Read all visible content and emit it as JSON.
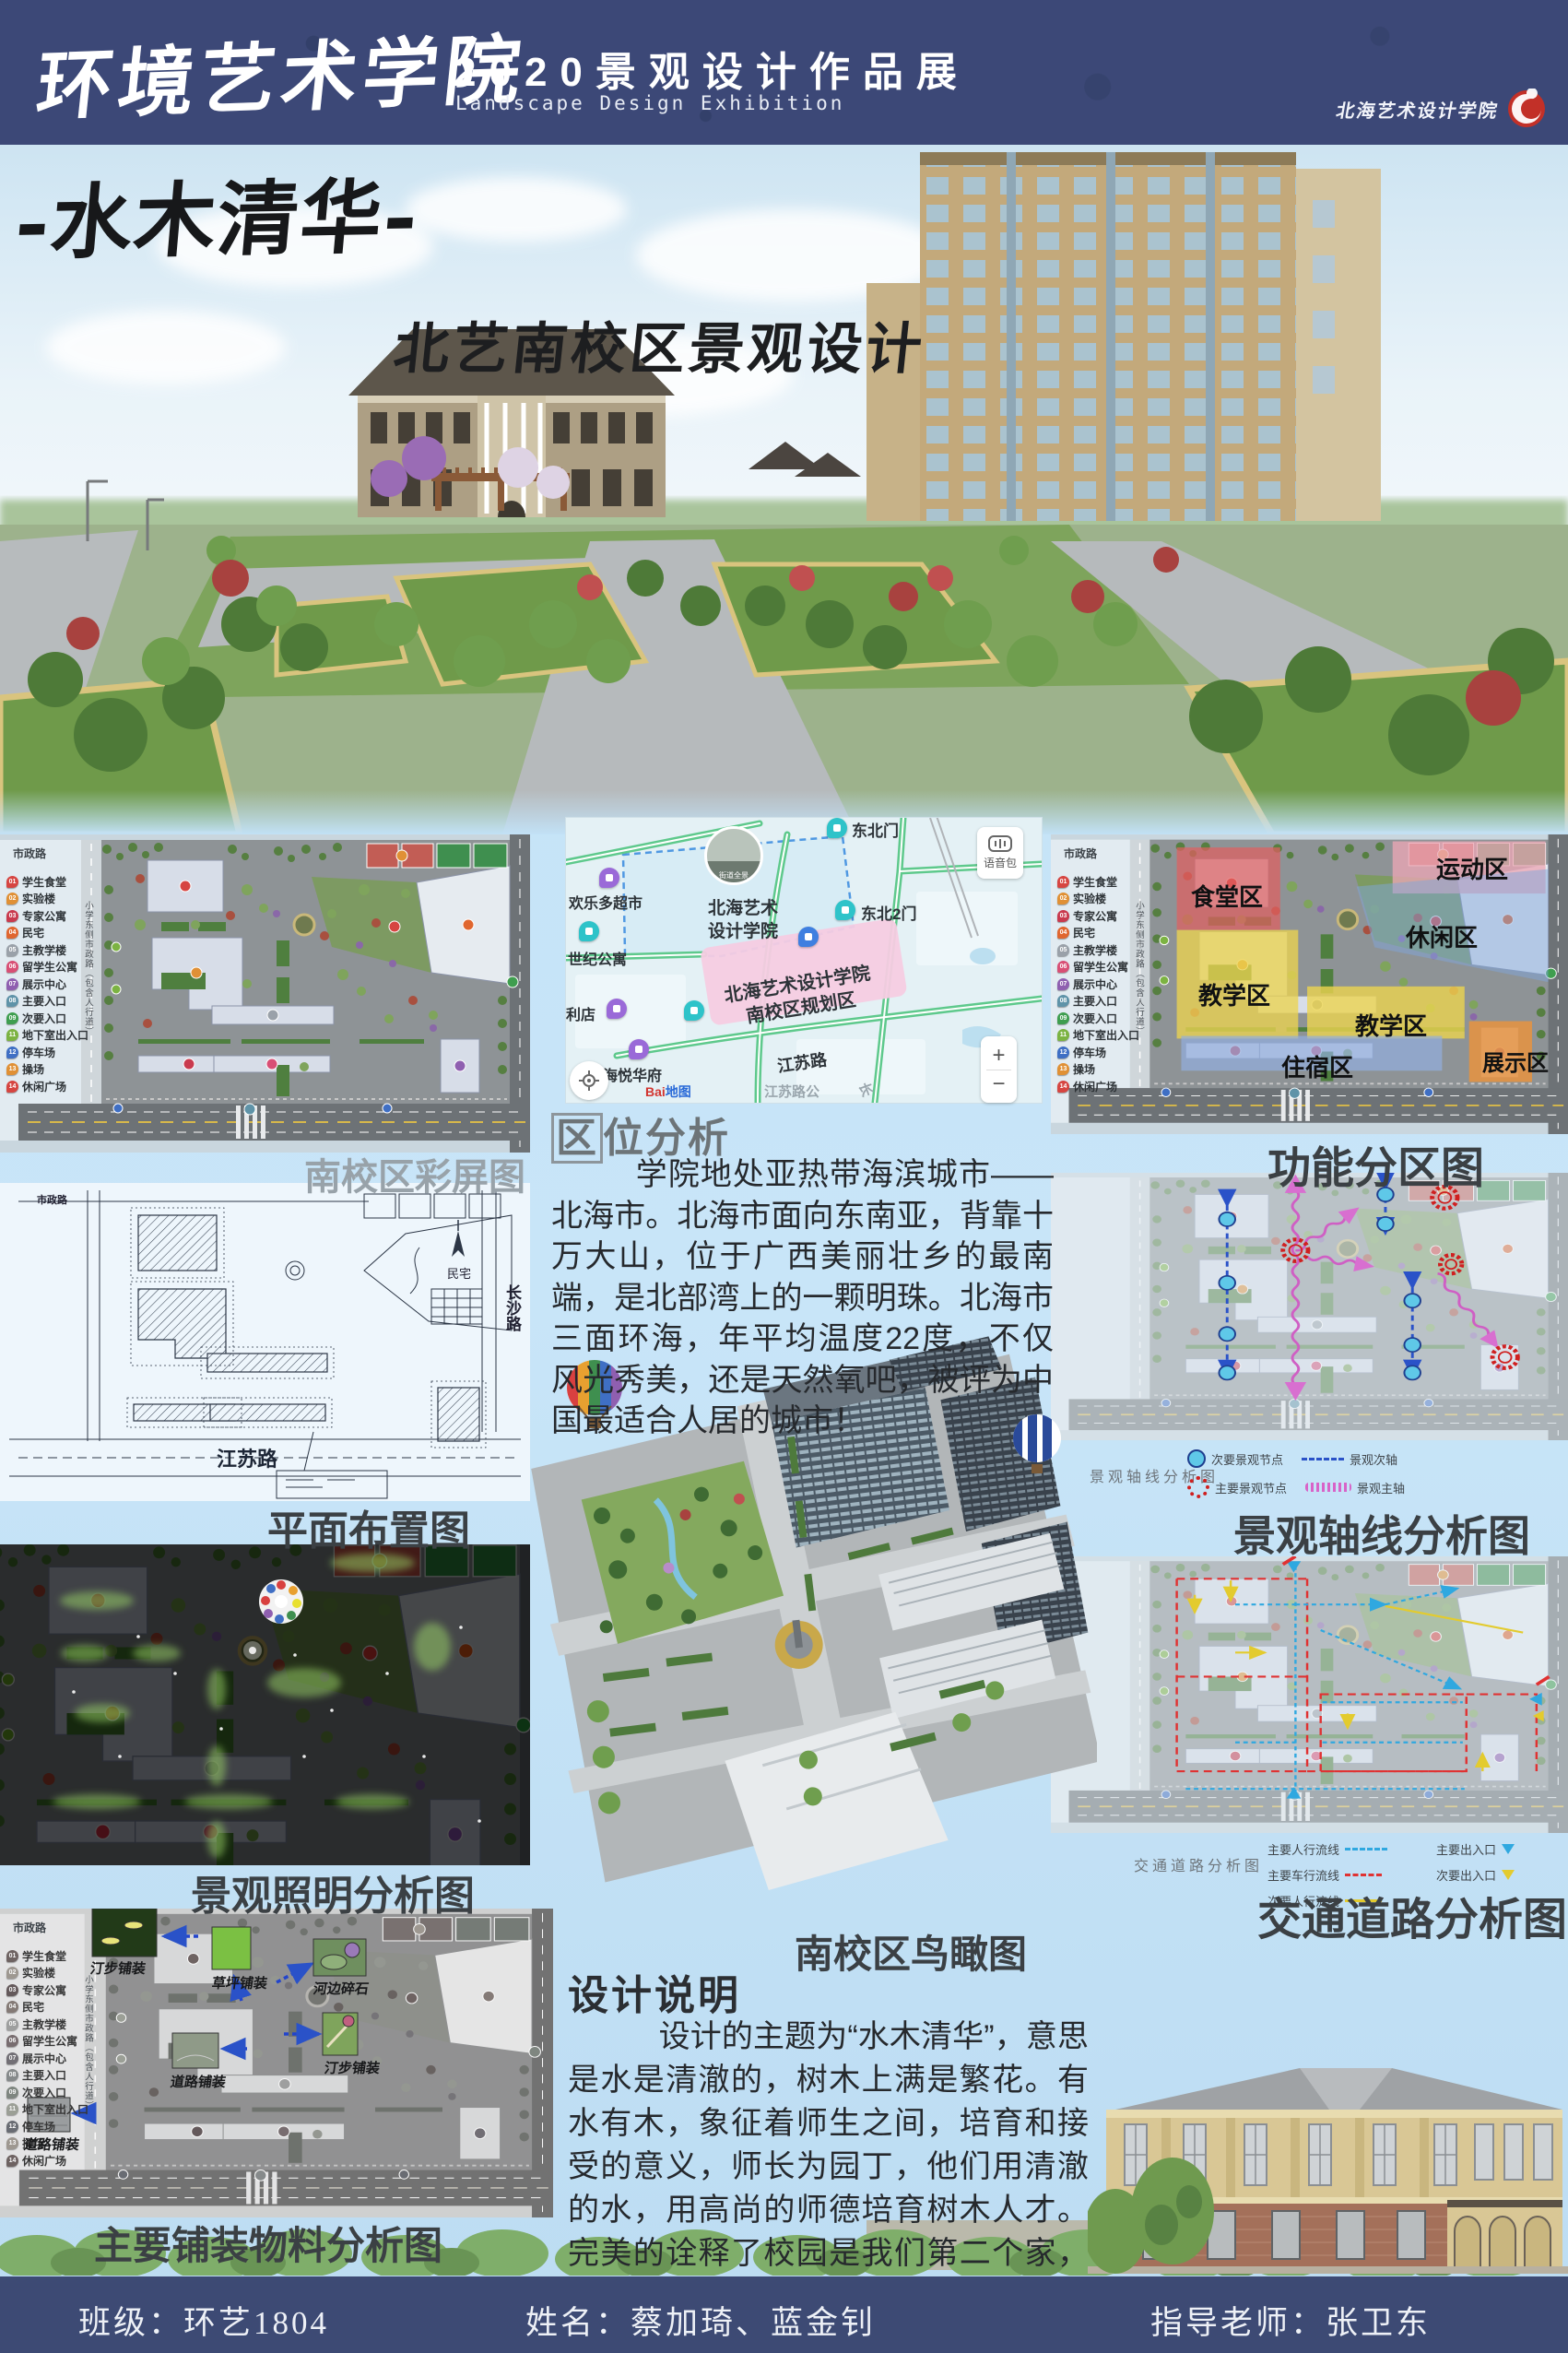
{
  "colors": {
    "header_navy": "#3c4877",
    "footer_navy": "#3d4a74",
    "page_sky": "#c2e1f6",
    "caption_gray": "#98a2a9",
    "caption_dark": "#3b4044",
    "map_road_green": "#5ec98c",
    "map_boundary_blue": "#3f8fe0",
    "map_planning_pink": "#f6cce2",
    "logo_red": "#c23028"
  },
  "header": {
    "school_name": "环境艺术学院",
    "exhibition_title_cn": "2020景观设计作品展",
    "exhibition_title_en": "Landscape Design Exhibition",
    "logo_text": "北海艺术设计学院"
  },
  "hero": {
    "title": "-水木清华-",
    "subtitle": "北艺南校区景观设计"
  },
  "legend": {
    "road_top": "市政路",
    "road_side": "小学东侧市政路（包含人行道）",
    "items": [
      {
        "num": "01",
        "label": "学生食堂",
        "color": "#d64541"
      },
      {
        "num": "02",
        "label": "实验楼",
        "color": "#e09035"
      },
      {
        "num": "03",
        "label": "专家公寓",
        "color": "#c93a4e"
      },
      {
        "num": "04",
        "label": "民宅",
        "color": "#e0662f"
      },
      {
        "num": "05",
        "label": "主教学楼",
        "color": "#9aa1a9"
      },
      {
        "num": "06",
        "label": "留学生公寓",
        "color": "#d84f75"
      },
      {
        "num": "07",
        "label": "展示中心",
        "color": "#8f5fb0"
      },
      {
        "num": "08",
        "label": "主要入口",
        "color": "#5f93a8"
      },
      {
        "num": "09",
        "label": "次要入口",
        "color": "#3f9e4f"
      },
      {
        "num": "11",
        "label": "地下室出入口",
        "color": "#7cb342"
      },
      {
        "num": "12",
        "label": "停车场",
        "color": "#3f6fc4"
      },
      {
        "num": "13",
        "label": "操场",
        "color": "#e09035"
      },
      {
        "num": "14",
        "label": "休闲广场",
        "color": "#d64541"
      }
    ]
  },
  "panels": {
    "site_plan": {
      "caption": "南校区彩屏图"
    },
    "layout_plan": {
      "caption": "平面布置图",
      "label_top": "市政路",
      "label_right": "长沙路",
      "label_bottom": "江苏路",
      "label_area": "民宅"
    },
    "lighting": {
      "caption": "景观照明分析图"
    },
    "paving": {
      "caption": "主要铺装物料分析图",
      "labels": {
        "l1": "汀步铺装",
        "l2": "草坪铺装",
        "l3": "河边碎石",
        "l4": "道路铺装",
        "l5": "汀步铺装",
        "l6": "道路铺装"
      }
    },
    "function_zones": {
      "caption": "功能分区图",
      "zones": {
        "canteen": "食堂区",
        "sports": "运动区",
        "leisure": "休闲区",
        "teaching1": "教学区",
        "teaching2": "教学区",
        "dorm": "住宿区",
        "exhibition": "展示区"
      }
    },
    "axis": {
      "caption": "景观轴线分析图",
      "inner_caption": "景观轴线分析图",
      "legend": {
        "minor_node": "次要景观节点",
        "major_node": "主要景观节点",
        "minor_axis": "景观次轴",
        "major_axis": "景观主轴"
      }
    },
    "traffic": {
      "caption": "交通道路分析图",
      "inner_caption": "交通道路分析图",
      "legend": {
        "ped_main": "主要人行流线",
        "veh_main": "主要车行流线",
        "ped_minor": "次要人行流线",
        "entry_main": "主要出入口",
        "entry_minor": "次要出入口"
      }
    }
  },
  "map": {
    "pano_label": "街道全景",
    "voice_label": "语音包",
    "school_line1": "北海艺术",
    "school_line2": "设计学院",
    "planning_line1": "北海艺术设计学院",
    "planning_line2": "南校区规划区",
    "gate_ne": "东北门",
    "gate_ne2": "东北2门",
    "supermarket": "欢乐多超市",
    "apartment": "世纪公寓",
    "store": "利店",
    "residence": "海悦华府",
    "road_jiangsu": "江苏路",
    "road_jiangsu_stop": "江苏路公",
    "road_chang": "长",
    "zoom_in": "+",
    "zoom_out": "−",
    "brand_a": "Bai",
    "brand_b": "地图"
  },
  "location": {
    "heading_first": "区",
    "heading_rest": "位分析",
    "body": "学院地处亚热带海滨城市——北海市。北海市面向东南亚，背靠十万大山，位于广西美丽壮乡的最南端，是北部湾上的一颗明珠。北海市三面环海，年平均温度22度，不仅风光秀美，还是天然氧吧，被评为中国最适合人居的城市！"
  },
  "birdseye": {
    "caption": "南校区鸟瞰图"
  },
  "design": {
    "heading": "设计说明",
    "body": "设计的主题为“水木清华”，意思是水是清澈的，树木上满是繁花。有水有木，象征着师生之间，培育和接受的意义，师长为园丁，他们用清澈的水，用高尚的师德培育树木人才。完美的诠释了校园是我们第二个家，孕育了我们的成长，教导我们做人，是我们重要的港湾。"
  },
  "footer": {
    "class_label": "班级：环艺1804",
    "name_label": "姓名：蔡加琦、蓝金钊",
    "advisor_label": "指导老师：张卫东"
  }
}
